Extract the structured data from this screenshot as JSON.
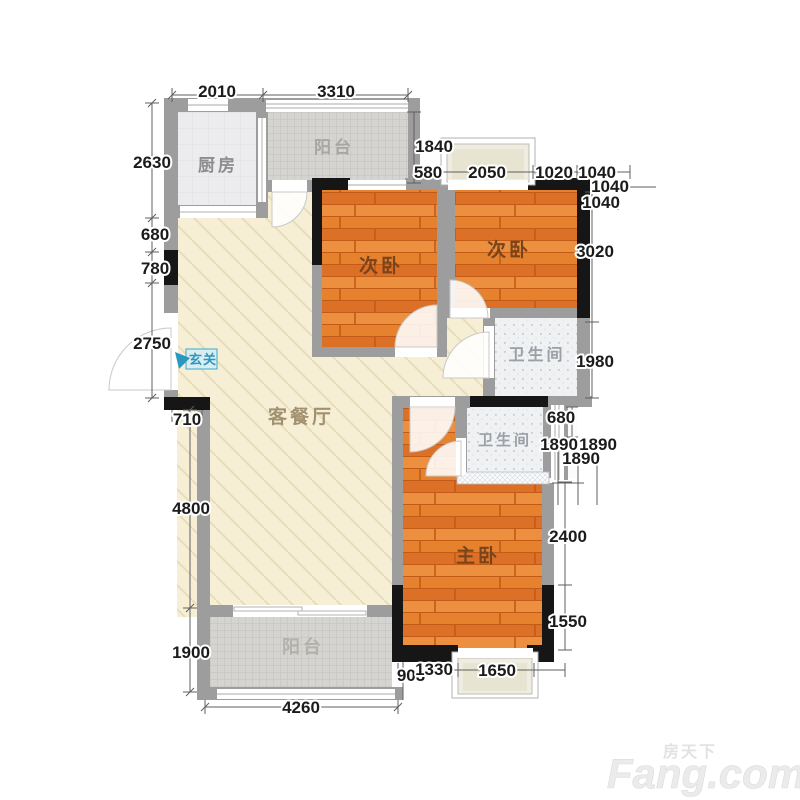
{
  "rooms": {
    "kitchen": "厨房",
    "balcony_top": "阳台",
    "bedroom_left": "次卧",
    "bedroom_right": "次卧",
    "bath_upper": "卫生间",
    "bath_lower": "卫生间",
    "living": "客餐厅",
    "entry": "玄关",
    "master": "主卧",
    "balcony_bottom": "阳台"
  },
  "dims": {
    "top": [
      "2010",
      "3310"
    ],
    "left": [
      "2630",
      "680",
      "780",
      "2750",
      "710",
      "4800",
      "1900"
    ],
    "right_top": [
      "1840",
      "580",
      "2050",
      "1020",
      "1040",
      "1040",
      "1040",
      "3020",
      "1980"
    ],
    "shaft": [
      "680",
      "1890",
      "1890",
      "1890"
    ],
    "right_bottom": [
      "2400",
      "1550"
    ],
    "bottom": [
      "903",
      "1330",
      "1650",
      "4260"
    ]
  },
  "watermark": {
    "cn": "房天下",
    "en": "Fang.com"
  },
  "colors": {
    "wall": "#9d9d9d",
    "structural": "#161616",
    "wood": "#e2792e",
    "living_floor": "#f7efd5",
    "entry_blue": "#2b98c0"
  }
}
